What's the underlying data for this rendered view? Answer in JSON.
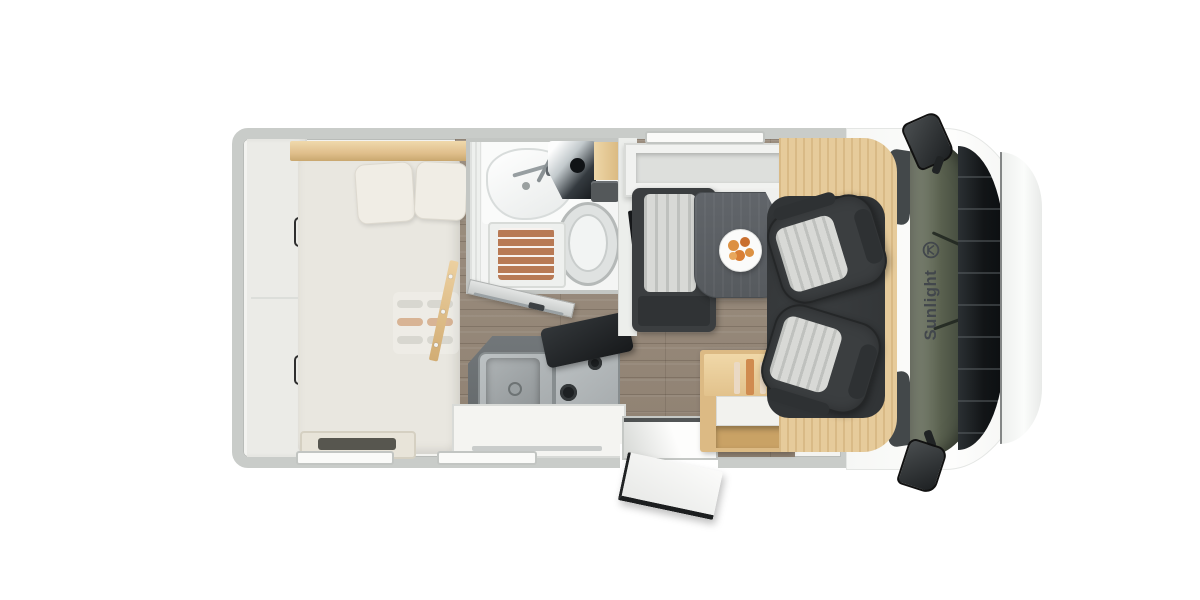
{
  "vehicle": {
    "brand_label": "Sunlight"
  },
  "palette": {
    "wall": "#c9ccc9",
    "wall_line": "#b9bcb9",
    "interior": "#f3f3f0",
    "floor_wood": "#9d9081",
    "wood_light": "#e0bf8c",
    "wood_edge": "#c9a76f",
    "wood_cabinet": "#dcba84",
    "wood_cab_floor": "#e6cb9b",
    "mattress": "#e9e7e0",
    "pillow": "#f0ede5",
    "bath": "#f4f5f4",
    "shower_mat": "#b87a55",
    "toilet_ring": "#b5b9b8",
    "counter": "#63686a",
    "steel": "#a4a9ab",
    "steel_dark": "#878d8f",
    "burner": "#1d2022",
    "seat": "#3b3e40",
    "seat_dark": "#2e3133",
    "stripe_light": "#d8d9d6",
    "stripe_line": "#bfc1be",
    "table": "#565a5e",
    "carpet": "#313436",
    "glass_light": "#5a614f",
    "glass_dark": "#2c322a",
    "grille": "#17191b",
    "bumper": "#fbfcfb",
    "mirror": "#1c1f21",
    "brand": "#42474c",
    "fruit": "#dc9143",
    "candle": "#ead9c4",
    "candle_orange": "#d08b4f",
    "white_panel": "#f4f4f1",
    "window_strip": "#fafaf8",
    "door_gray": "#c6c9c8"
  }
}
